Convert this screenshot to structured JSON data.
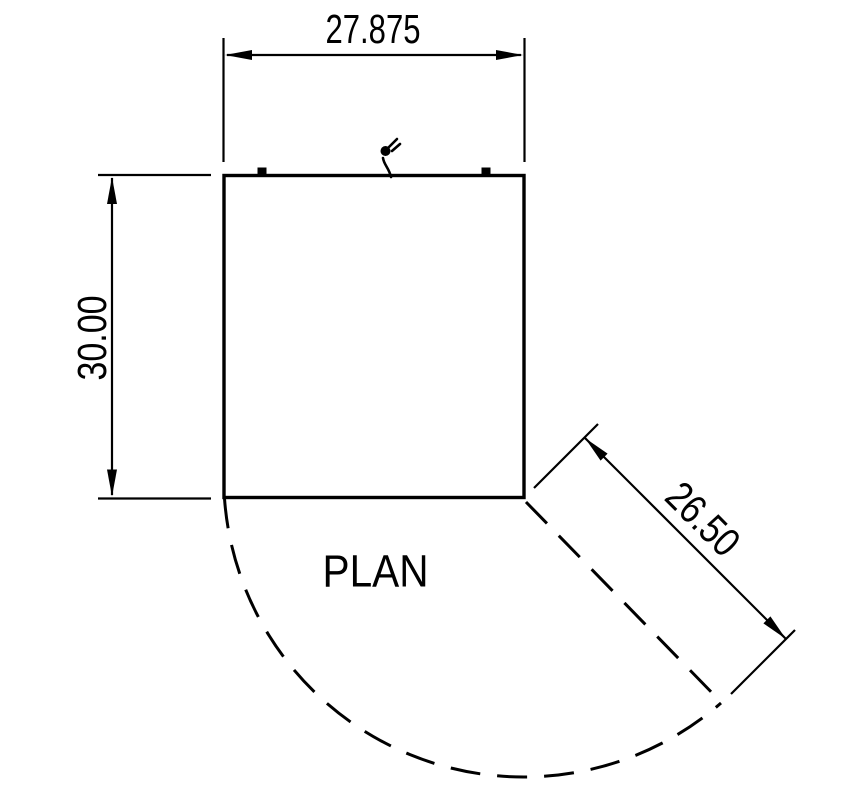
{
  "drawing": {
    "title": "PLAN",
    "dimensions": {
      "width": {
        "value": "27.875",
        "orientation": "horizontal-top"
      },
      "depth": {
        "value": "30.00",
        "orientation": "vertical-left"
      },
      "door_swing": {
        "value": "26.50",
        "orientation": "diagonal-45"
      }
    },
    "features": {
      "power_cord_icon": "plug-icon",
      "hinge_left_icon": "hinge-marker",
      "hinge_right_icon": "hinge-marker",
      "door_swing_arc": "dashed arc from front-left corner to open door tip",
      "door_open_line": "dashed line from front-right corner at 45 degrees"
    },
    "colors": {
      "line": "#000000",
      "background": "#ffffff"
    }
  }
}
